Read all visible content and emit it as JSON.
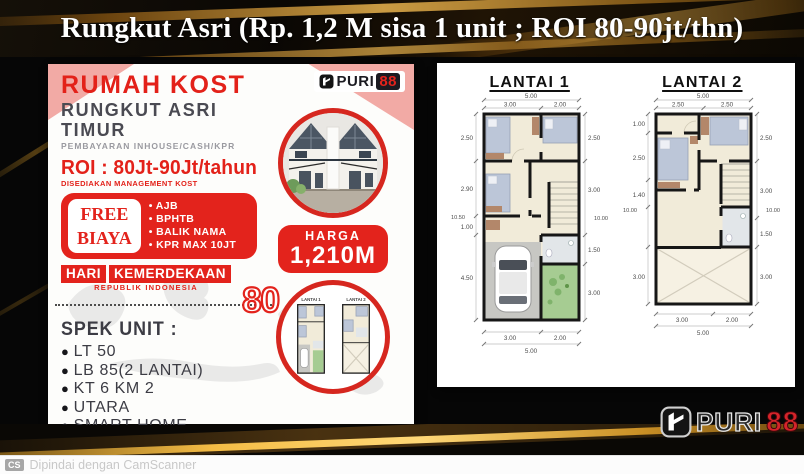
{
  "title_bar": {
    "text": "Rungkut Asri (Rp. 1,2 M sisa 1 unit ; ROI 80-90jt/thn)"
  },
  "flyer": {
    "headline": "RUMAH KOST",
    "location": "RUNGKUT ASRI TIMUR",
    "payment_note": "PEMBAYARAN INHOUSE/CASH/KPR",
    "roi": "ROI : 80Jt-90Jt/tahun",
    "roi_note": "DISEDIAKAN MANAGEMENT KOST",
    "free_box": {
      "line1": "FREE",
      "line2": "BIAYA",
      "items": [
        "AJB",
        "BPHTB",
        "BALIK NAMA",
        "KPR MAX 10JT"
      ]
    },
    "independence": {
      "word1": "HARI",
      "word2": "KEMERDEKAAN",
      "subtitle": "REPUBLIK INDONESIA",
      "number": "80"
    },
    "spec_title": "SPEK UNIT :",
    "specs": [
      "LT 50",
      "LB 85(2 LANTAI)",
      "KT 6 KM 2",
      "UTARA",
      "SMART HOME",
      "PAGAR - KANOPI"
    ],
    "brand": {
      "name": "PURI",
      "number": "88"
    },
    "price": {
      "label": "HARGA",
      "value": "1,210M"
    },
    "mini_plans": {
      "label1": "LANTAI 1",
      "label2": "LANTAI 2"
    }
  },
  "plans": {
    "lantai1": {
      "title": "LANTAI 1",
      "dims": {
        "tt": "5.00",
        "ta": "3.00",
        "tb": "2.00",
        "la": "2.50",
        "lb": "2.90",
        "lc": "1.00",
        "ld": "4.50",
        "lt": "10.50",
        "ra": "2.50",
        "rb": "3.00",
        "rc": "1.50",
        "rd": "3.00",
        "rt": "10.00",
        "ba": "3.00",
        "bb": "2.00",
        "bt": "5.00"
      }
    },
    "lantai2": {
      "title": "LANTAI 2",
      "dims": {
        "tt": "5.00",
        "ta": "2.50",
        "tb": "2.50",
        "la": "1.00",
        "lb": "2.50",
        "lc": "1.40",
        "ld": "3.00",
        "lt": "10.00",
        "ra": "2.50",
        "rb": "3.00",
        "rc": "1.50",
        "rd": "3.00",
        "rt": "10.00",
        "ba": "3.00",
        "bb": "2.00",
        "bt": "5.00"
      }
    }
  },
  "footer": {
    "brand": {
      "name": "PURI",
      "number": "88"
    },
    "scanner": {
      "badge": "CS",
      "text": "Dipindai dengan CamScanner"
    }
  },
  "colors": {
    "red": "#e3231c",
    "gold": "#eab44e",
    "pink": "#f2aaa5",
    "dark": "#0a0805"
  }
}
